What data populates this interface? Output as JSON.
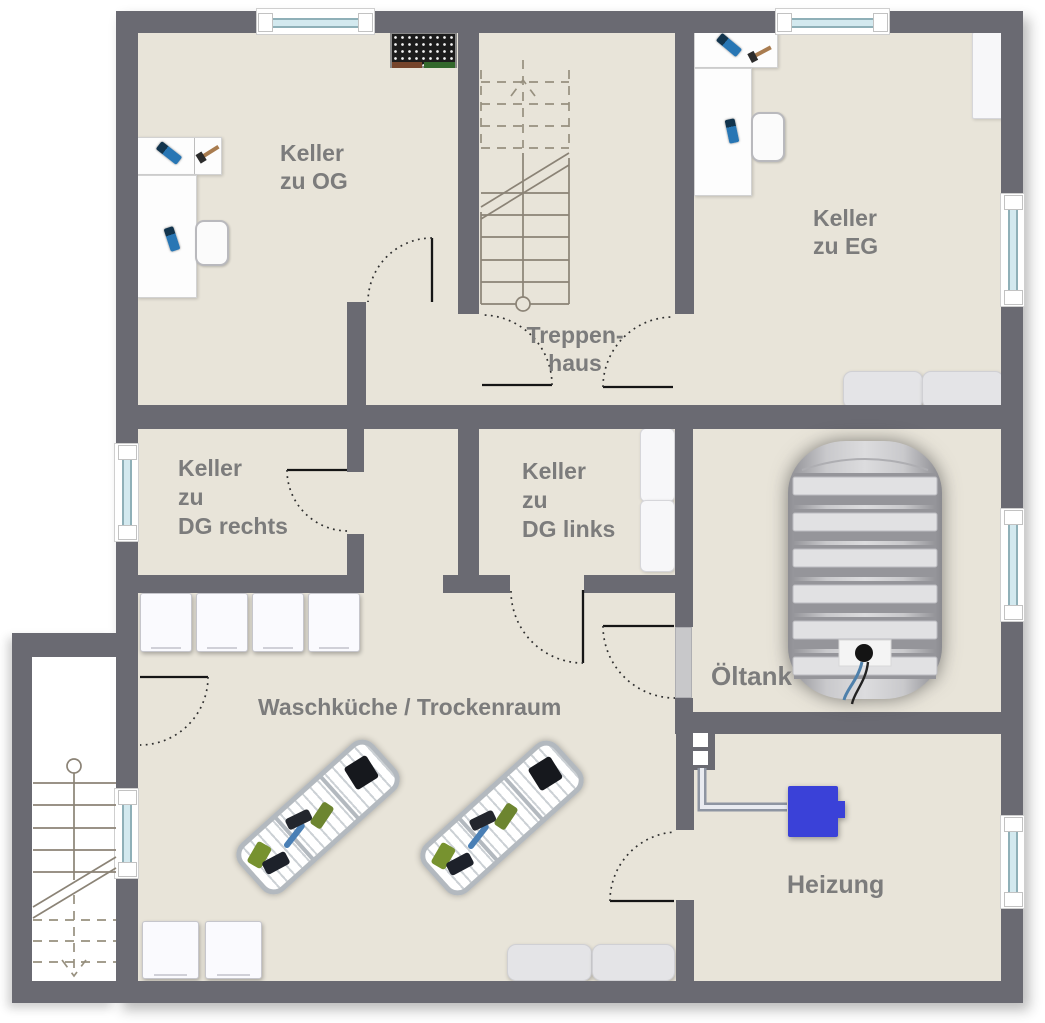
{
  "rooms": {
    "keller_og": {
      "line1": "Keller",
      "line2": "zu OG"
    },
    "keller_eg": {
      "line1": "Keller",
      "line2": "zu EG"
    },
    "treppenhaus": {
      "line1": "Treppen-",
      "line2": "haus"
    },
    "keller_dg_rechts": {
      "line1": "Keller",
      "line2": "zu",
      "line3": "DG rechts"
    },
    "keller_dg_links": {
      "line1": "Keller",
      "line2": "zu",
      "line3": "DG links"
    },
    "oeltank": {
      "label": "Öltank"
    },
    "waschkueche": {
      "label": "Waschküche / Trockenraum"
    },
    "heizung": {
      "label": "Heizung"
    }
  },
  "colors": {
    "wall": "#6a6a72",
    "floor": "#e8e4d9",
    "exterior": "#ffffff",
    "label_text": "#7c7c7c",
    "window_glass": "#d3e9ef",
    "boiler_blue": "#3a41d8",
    "oil_tank_gray": "#c4c4c6",
    "door_leaf": "#151515"
  }
}
